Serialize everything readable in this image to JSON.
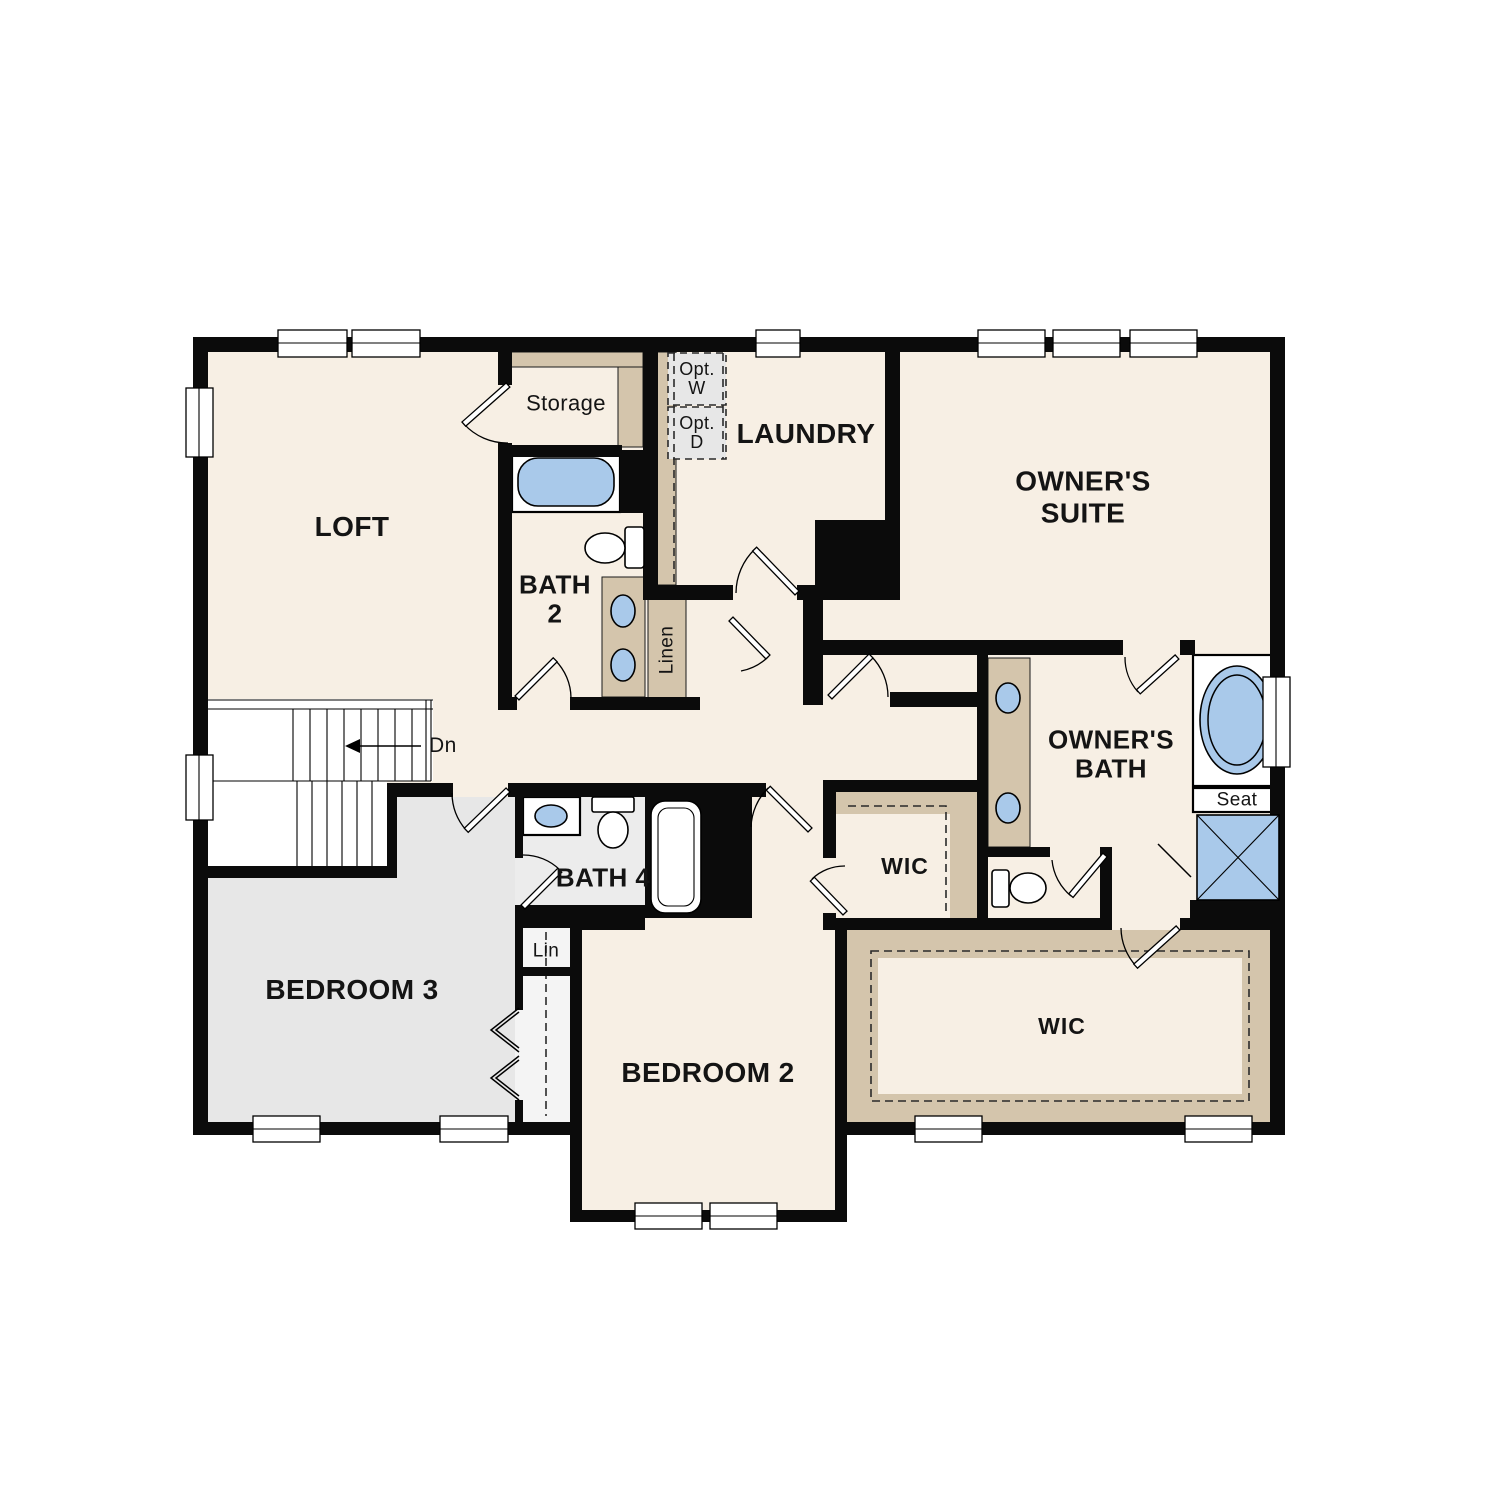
{
  "colors": {
    "wall_black": "#0b0b0b",
    "floor_cream": "#f7efe4",
    "floor_gray": "#e7e7e7",
    "floor_bath_gray": "#ececec",
    "closet_tan": "#d4c5ac",
    "fixture_blue": "#a9c9ea",
    "background": "#ffffff"
  },
  "rooms": {
    "loft": {
      "label": "LOFT"
    },
    "storage": {
      "label": "Storage"
    },
    "laundry": {
      "label": "LAUNDRY"
    },
    "owners_suite": {
      "label": "OWNER'S\nSUITE"
    },
    "bath_2": {
      "label": "BATH\n2"
    },
    "owners_bath": {
      "label": "OWNER'S\nBATH"
    },
    "bath_4": {
      "label": "BATH 4"
    },
    "bedroom_3": {
      "label": "BEDROOM 3"
    },
    "bedroom_2": {
      "label": "BEDROOM 2"
    },
    "wic_bedroom_2": {
      "label": "WIC"
    },
    "wic_owners": {
      "label": "WIC"
    }
  },
  "closets": {
    "linen": {
      "label": "Linen"
    },
    "lin": {
      "label": "Lin"
    }
  },
  "annotations": {
    "stairs_down": {
      "label": "Dn"
    },
    "opt_washer": {
      "label": "Opt.\nW"
    },
    "opt_dryer": {
      "label": "Opt.\nD"
    },
    "shower_seat": {
      "label": "Seat"
    }
  }
}
